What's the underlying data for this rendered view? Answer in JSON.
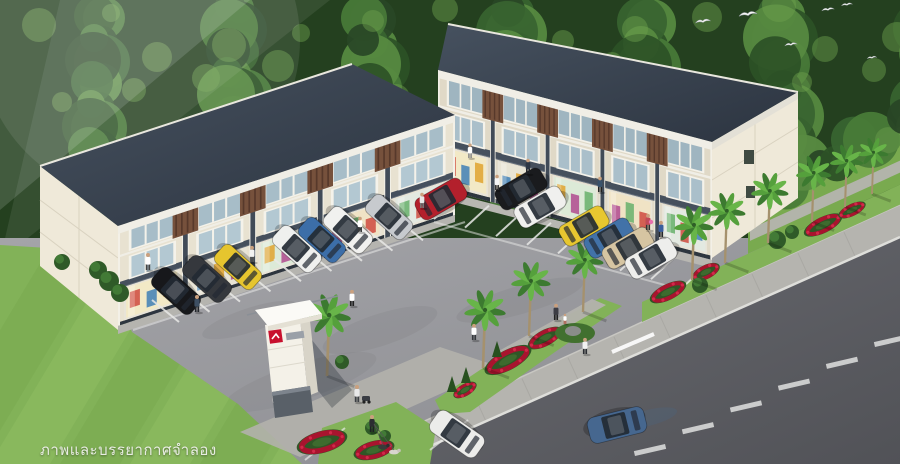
{
  "image_type": "architectural-rendering",
  "caption": "ภาพและบรรยากาศจำลอง",
  "scene": {
    "description": "Aerial 3D rendering of two 3-storey commercial shophouse blocks with bright storefronts, an angled parking lot full of cars, palm trees, red flower beds, a white project pylon sign, pedestrians, and a road frontage with a passing car; dense green trees behind and birds in the sky.",
    "palette": {
      "canopy": [
        "#2c5126",
        "#386430",
        "#497b38",
        "#588b41",
        "#294626"
      ],
      "canopy_highlight": "#6ea24e",
      "roof_light": "#46515f",
      "roof_dark": "#2c3440",
      "fascia": "#f0eee6",
      "wall_left": "#e8e2d1",
      "wall_right": "#e0d9c7",
      "end_wall": "#efe9d9",
      "pier": "#414b58",
      "canopy_band": "#46505d",
      "wood": "#76513c",
      "wood_dark": "#57392b",
      "glass_upper": "#a7bdc8",
      "glass_upper2": "#9fb5c0",
      "frame": "#f4f2ea",
      "shopfronts": [
        "#f2e9c6",
        "#e8e4d4",
        "#dcead7",
        "#f0e3c5",
        "#e3e9e1"
      ],
      "merchandise": [
        "#cf4a3e",
        "#3f7fb5",
        "#e0a32e",
        "#b04a8f",
        "#67b06b"
      ],
      "asphalt_light": "#a4a4a8",
      "asphalt_dark": "#8a8b90",
      "road_light": "#66676d",
      "road_dark": "#515257",
      "sidewalk": "#b5b4af",
      "curb": "#dededa",
      "grass": "#82b258",
      "grass_light": "#93c167",
      "lawn": "#79aa4f",
      "palm_fronds": [
        "#3c7a30",
        "#55a03c",
        "#68b549"
      ],
      "palm_trunk": "#a5916d",
      "flower_ring": "#a8142e",
      "flower_dot": "#d2294a",
      "bed_leaf": "#305626",
      "sign_white": "#f4f1e8",
      "sign_base": "#596068",
      "sign_logo": "#c8102e",
      "marking": "#e9e9e7",
      "bird": "#f6f6f4",
      "skin": "#caa07e"
    },
    "buildings": [
      {
        "id": "left-block",
        "floors": 3,
        "units": 5
      },
      {
        "id": "right-block",
        "floors": 3,
        "units": 5
      }
    ],
    "cars": [
      {
        "c": "#17181b",
        "x": 176,
        "y": 291,
        "r": 222,
        "l": 52
      },
      {
        "c": "#35383d",
        "x": 207,
        "y": 279,
        "r": 222,
        "l": 52
      },
      {
        "c": "#e6c52e",
        "x": 238,
        "y": 267,
        "r": 222,
        "l": 50
      },
      {
        "c": "#eff0ee",
        "x": 297,
        "y": 249,
        "r": 222,
        "l": 52
      },
      {
        "c": "#3c6ea8",
        "x": 322,
        "y": 240,
        "r": 222,
        "l": 50
      },
      {
        "c": "#f1f1ef",
        "x": 348,
        "y": 230,
        "r": 222,
        "l": 52
      },
      {
        "c": "#c7cace",
        "x": 389,
        "y": 217,
        "r": 222,
        "l": 50
      },
      {
        "c": "#b3202c",
        "x": 441,
        "y": 199,
        "r": -30,
        "l": 52
      },
      {
        "c": "#1a1b1e",
        "x": 521,
        "y": 189,
        "r": -30,
        "l": 52
      },
      {
        "c": "#f0f0ee",
        "x": 540,
        "y": 207,
        "r": -30,
        "l": 52
      },
      {
        "c": "#e7c730",
        "x": 584,
        "y": 226,
        "r": -30,
        "l": 50
      },
      {
        "c": "#4272a8",
        "x": 609,
        "y": 238,
        "r": -30,
        "l": 50
      },
      {
        "c": "#d6c5a2",
        "x": 628,
        "y": 248,
        "r": -30,
        "l": 52
      },
      {
        "c": "#eeeeec",
        "x": 651,
        "y": 258,
        "r": -30,
        "l": 52
      }
    ],
    "road_cars": [
      {
        "c": "#46678f",
        "x": 617,
        "y": 425,
        "r": 166,
        "l": 58
      },
      {
        "c": "#ececea",
        "x": 457,
        "y": 434,
        "r": 215,
        "l": 56
      }
    ],
    "palms": [
      [
        483,
        368,
        1.0
      ],
      [
        529,
        336,
        0.95
      ],
      [
        583,
        312,
        0.9
      ],
      [
        327,
        376,
        1.05
      ],
      [
        692,
        280,
        0.95
      ],
      [
        725,
        263,
        0.9
      ],
      [
        768,
        243,
        0.9
      ],
      [
        812,
        222,
        0.85
      ],
      [
        845,
        207,
        0.8
      ],
      [
        872,
        194,
        0.72
      ]
    ],
    "flowerbeds": [
      [
        322,
        442,
        26,
        11,
        -15
      ],
      [
        374,
        450,
        21,
        9,
        -15
      ],
      [
        508,
        360,
        26,
        10,
        -28
      ],
      [
        545,
        338,
        19,
        8,
        -28
      ],
      [
        668,
        292,
        20,
        8,
        -26
      ],
      [
        706,
        272,
        15,
        7,
        -26
      ],
      [
        823,
        225,
        21,
        8,
        -26
      ],
      [
        852,
        210,
        15,
        6,
        -26
      ],
      [
        465,
        390,
        13,
        6,
        -30
      ]
    ],
    "bushes": [
      [
        98,
        270,
        9
      ],
      [
        109,
        281,
        10
      ],
      [
        120,
        293,
        9
      ],
      [
        62,
        262,
        8
      ],
      [
        342,
        362,
        7
      ],
      [
        372,
        428,
        7
      ],
      [
        385,
        436,
        6
      ],
      [
        700,
        285,
        8
      ],
      [
        777,
        240,
        9
      ],
      [
        792,
        232,
        7
      ]
    ],
    "conifers": [
      [
        452,
        392
      ],
      [
        466,
        383
      ],
      [
        497,
        357
      ]
    ],
    "rock": [
      575,
      333
    ],
    "people": [
      [
        148,
        270,
        "#ffffff",
        "#444444",
        1.0
      ],
      [
        197,
        312,
        "#3d4f63",
        "#23262b",
        1.0
      ],
      [
        252,
        262,
        "#f2f2f2",
        "#555555",
        0.95
      ],
      [
        360,
        232,
        "#ffffff",
        "#3a3a3a",
        0.9
      ],
      [
        422,
        208,
        "#e8e8e8",
        "#777777",
        0.9
      ],
      [
        470,
        158,
        "#ffffff",
        "#888888",
        0.85
      ],
      [
        497,
        190,
        "#f5f5f5",
        "#333333",
        0.9
      ],
      [
        528,
        174,
        "#2e3744",
        "#1e2228",
        0.9
      ],
      [
        600,
        192,
        "#39526b",
        "#222222",
        0.9
      ],
      [
        648,
        230,
        "#c14a56",
        "#333333",
        0.95
      ],
      [
        661,
        237,
        "#3a5f9e",
        "#23262b",
        0.95
      ],
      [
        556,
        320,
        "#3c3c44",
        "#222222",
        0.95
      ],
      [
        565,
        324,
        "#ffffff",
        "#b05a4a",
        0.6
      ],
      [
        474,
        340,
        "#ffffff",
        "#35383d",
        0.95
      ],
      [
        352,
        306,
        "#ffffff",
        "#222222",
        0.95
      ],
      [
        585,
        354,
        "#f2f2f2",
        "#2b2e33",
        0.95
      ],
      [
        357,
        402,
        "#e9e9e9",
        "#3c3f44",
        1.0
      ],
      [
        372,
        432,
        "#2b2d31",
        "#1f2124",
        1.0
      ]
    ],
    "dogs": [
      [
        383,
        447
      ],
      [
        394,
        452
      ]
    ],
    "birds": [
      [
        703,
        22,
        1.1
      ],
      [
        748,
        15,
        1.3
      ],
      [
        791,
        45,
        0.9
      ],
      [
        828,
        10,
        0.9
      ],
      [
        847,
        5,
        0.8
      ],
      [
        872,
        58,
        0.7
      ]
    ]
  }
}
